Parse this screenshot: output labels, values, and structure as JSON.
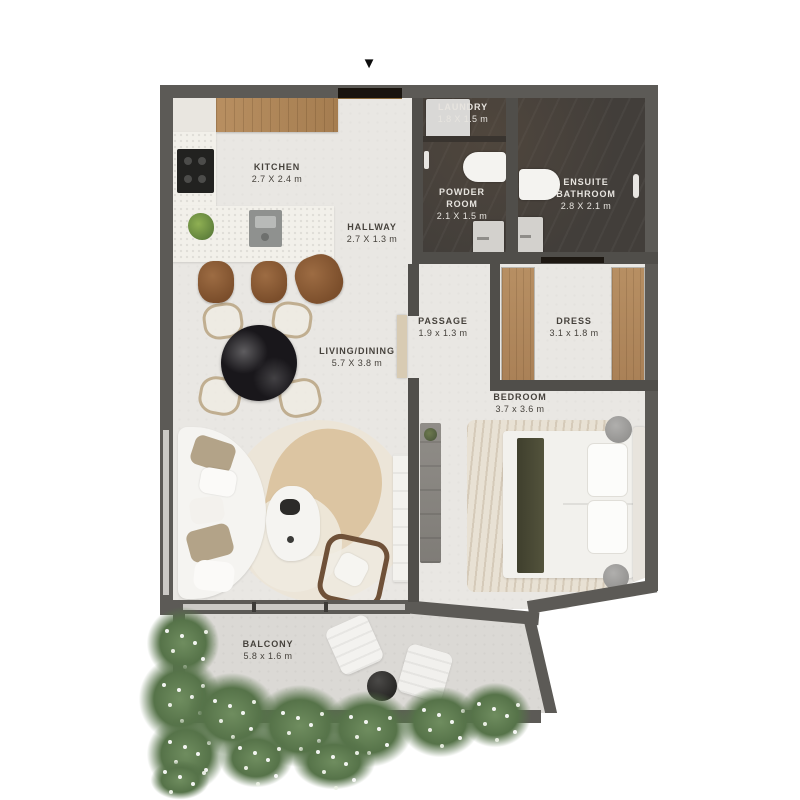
{
  "entry": {
    "marker": "▼"
  },
  "rooms": {
    "kitchen": {
      "label": "KITCHEN",
      "dims": "2.7 X 2.4 m"
    },
    "hallway": {
      "label": "HALLWAY",
      "dims": "2.7 X 1.3 m"
    },
    "laundry": {
      "label": "LAUNDRY",
      "dims": "1.8 X 1.5 m"
    },
    "powder_room": {
      "label": "POWDER",
      "label2": "ROOM",
      "dims": "2.1 X 1.5 m"
    },
    "ensuite_bathroom": {
      "label": "ENSUITE",
      "label2": "BATHROOM",
      "dims": "2.8 X 2.1 m"
    },
    "passage": {
      "label": "PASSAGE",
      "dims": "1.9 x 1.3 m"
    },
    "dress": {
      "label": "DRESS",
      "dims": "3.1 x 1.8 m"
    },
    "living_dining": {
      "label": "LIVING/DINING",
      "dims": "5.7 X 3.8 m"
    },
    "bedroom": {
      "label": "BEDROOM",
      "dims": "3.7 x 3.6 m"
    },
    "balcony": {
      "label": "BALCONY",
      "dims": "5.8 x 1.6 m"
    }
  },
  "colors": {
    "exterior_wall": "#5c5a56",
    "interior_wall": "#504e4a",
    "unit_floor": "#e9e7e3",
    "balcony_floor": "#dbd9d5",
    "bathroom_tile": "#423e3a",
    "wood": "#b1895f",
    "marble": "#f2f0ea",
    "plant_green": "#5f7d53",
    "label_dark": "#46423c",
    "label_light": "#e7e4df"
  }
}
